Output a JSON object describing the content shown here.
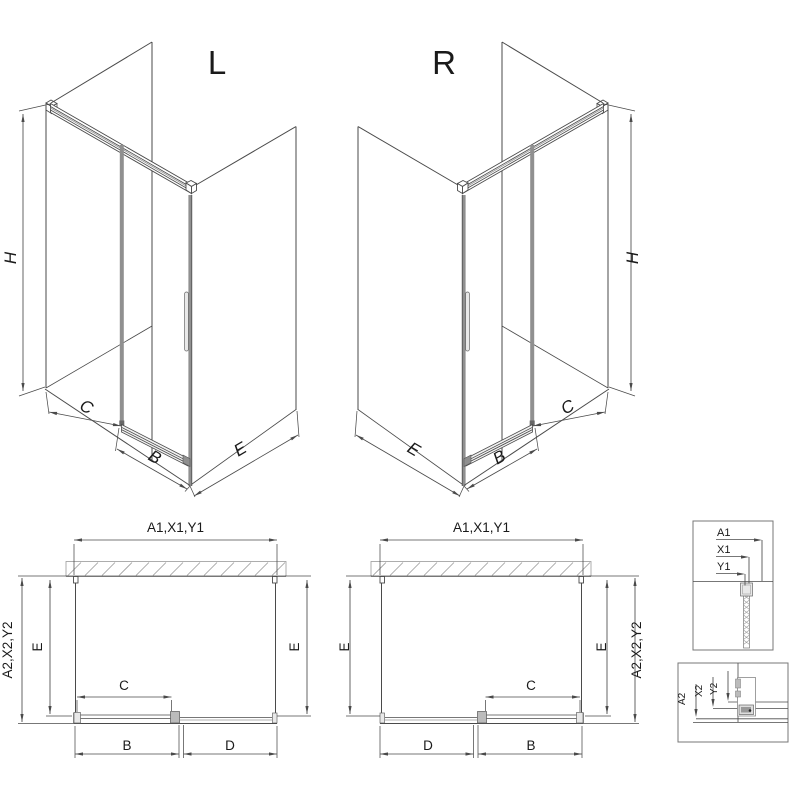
{
  "drawing": {
    "iso_left": {
      "title": "L",
      "dim_height": "H",
      "dim_opening": "C",
      "dim_door": "B",
      "dim_side": "E"
    },
    "iso_right": {
      "title": "R",
      "dim_height": "H",
      "dim_opening": "C",
      "dim_door": "B",
      "dim_side": "E"
    },
    "plan_left": {
      "dim_width": "A1,X1,Y1",
      "dim_depth_outer": "A2,X2,Y2",
      "dim_side_left": "E",
      "dim_side_right": "E",
      "dim_opening": "C",
      "dim_door": "B",
      "dim_fixed": "D"
    },
    "plan_right": {
      "dim_width": "A1,X1,Y1",
      "dim_depth_outer": "A2,X2,Y2",
      "dim_side_left": "E",
      "dim_side_right": "E",
      "dim_opening": "C",
      "dim_door": "B",
      "dim_fixed": "D"
    },
    "detail_top": {
      "labels": [
        "A1",
        "X1",
        "Y1"
      ]
    },
    "detail_bottom": {
      "labels": [
        "A2",
        "X2",
        "Y2"
      ]
    },
    "colors": {
      "line": "#4a4a4a",
      "light_line": "#999999",
      "profile_gray": "#8f8f8f",
      "text": "#1a1a1a",
      "background": "#ffffff"
    }
  }
}
